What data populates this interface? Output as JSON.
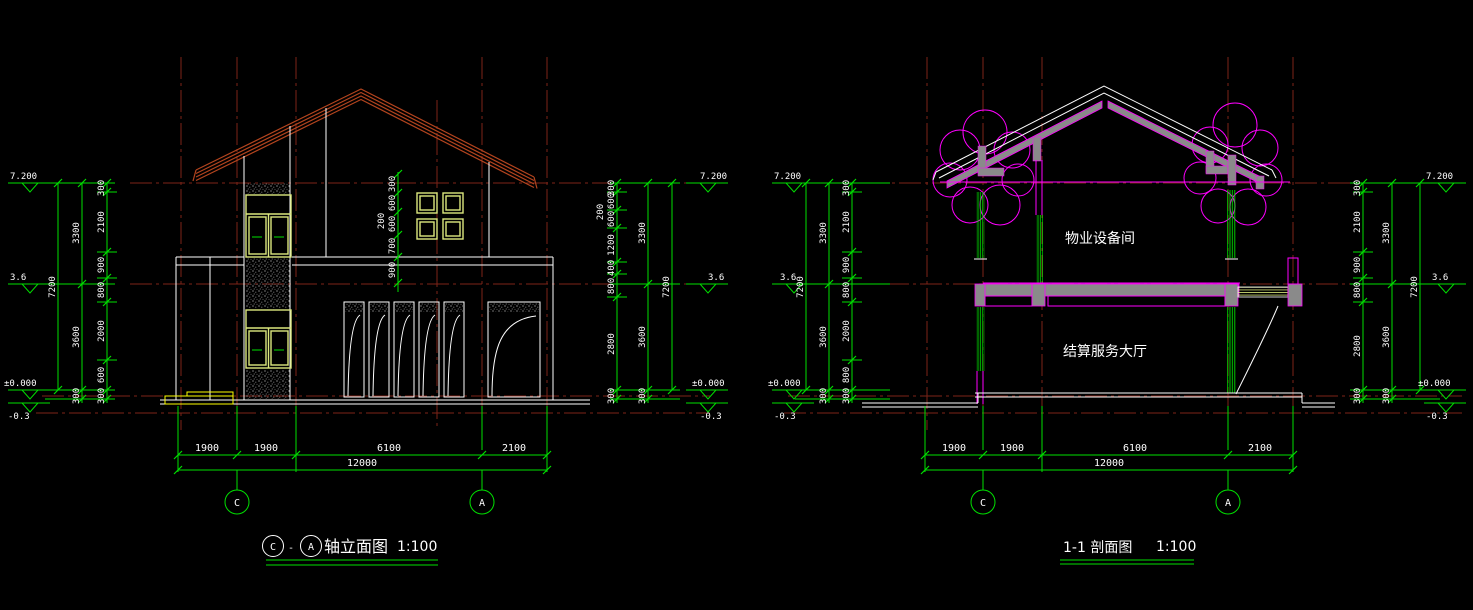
{
  "colors": {
    "background": "#000000",
    "dimension_green": "#00DF00",
    "line_white": "#FFFFFF",
    "grid_red": "#7E2418",
    "roof_red": "#B3441E",
    "magenta": "#FF00FF",
    "window_yellow_green": "#DCE87E",
    "step_yellow": "#FFFF00",
    "slab_gray": "#8A8A8A"
  },
  "left": {
    "elev": {
      "l": [
        "7.200",
        "3.6",
        "±0.000",
        "-0.3"
      ],
      "r": [
        "7.200",
        "3.6",
        "±0.000",
        "-0.3"
      ]
    },
    "chains": {
      "outer_l": "7200",
      "mid_l": [
        "3300",
        "3600",
        "300"
      ],
      "inner_l": [
        "300",
        "2100",
        "900",
        "800",
        "2000",
        "600",
        "300"
      ],
      "win": [
        "300",
        "600",
        "600",
        "700",
        "900"
      ],
      "win_off": "200",
      "inner_r": [
        "300",
        "600",
        "600",
        "1200",
        "400",
        "800",
        "2800",
        "300"
      ],
      "inner_r_off": "200",
      "mid_r": [
        "3300",
        "3600",
        "300"
      ],
      "outer_r": "7200"
    },
    "bottom": {
      "dims": [
        "1900",
        "1900",
        "6100",
        "2100"
      ],
      "total": "12000"
    },
    "bubbles": [
      "C",
      "A"
    ],
    "title": {
      "b1": "C",
      "sep": "-",
      "b2": "A",
      "name": "轴立面图",
      "scale": "1:100"
    }
  },
  "right": {
    "elev": {
      "l": [
        "7.200",
        "3.6",
        "±0.000",
        "-0.3"
      ],
      "r": [
        "7.200",
        "3.6",
        "±0.000",
        "-0.3"
      ]
    },
    "chains": {
      "outer_l": "7200",
      "mid_l": [
        "3300",
        "3600",
        "300"
      ],
      "inner_l": [
        "300",
        "2100",
        "900",
        "800",
        "2000",
        "800",
        "300"
      ],
      "inner_r": [
        "300",
        "2100",
        "900",
        "800",
        "2800",
        "300"
      ],
      "mid_r": [
        "3300",
        "3600",
        "300"
      ],
      "outer_r": "7200"
    },
    "rooms": [
      "物业设备间",
      "结算服务大厅"
    ],
    "bottom": {
      "dims": [
        "1900",
        "1900",
        "6100",
        "2100"
      ],
      "total": "12000"
    },
    "bubbles": [
      "C",
      "A"
    ],
    "title": {
      "name": "1-1 剖面图",
      "scale": "1:100"
    }
  }
}
